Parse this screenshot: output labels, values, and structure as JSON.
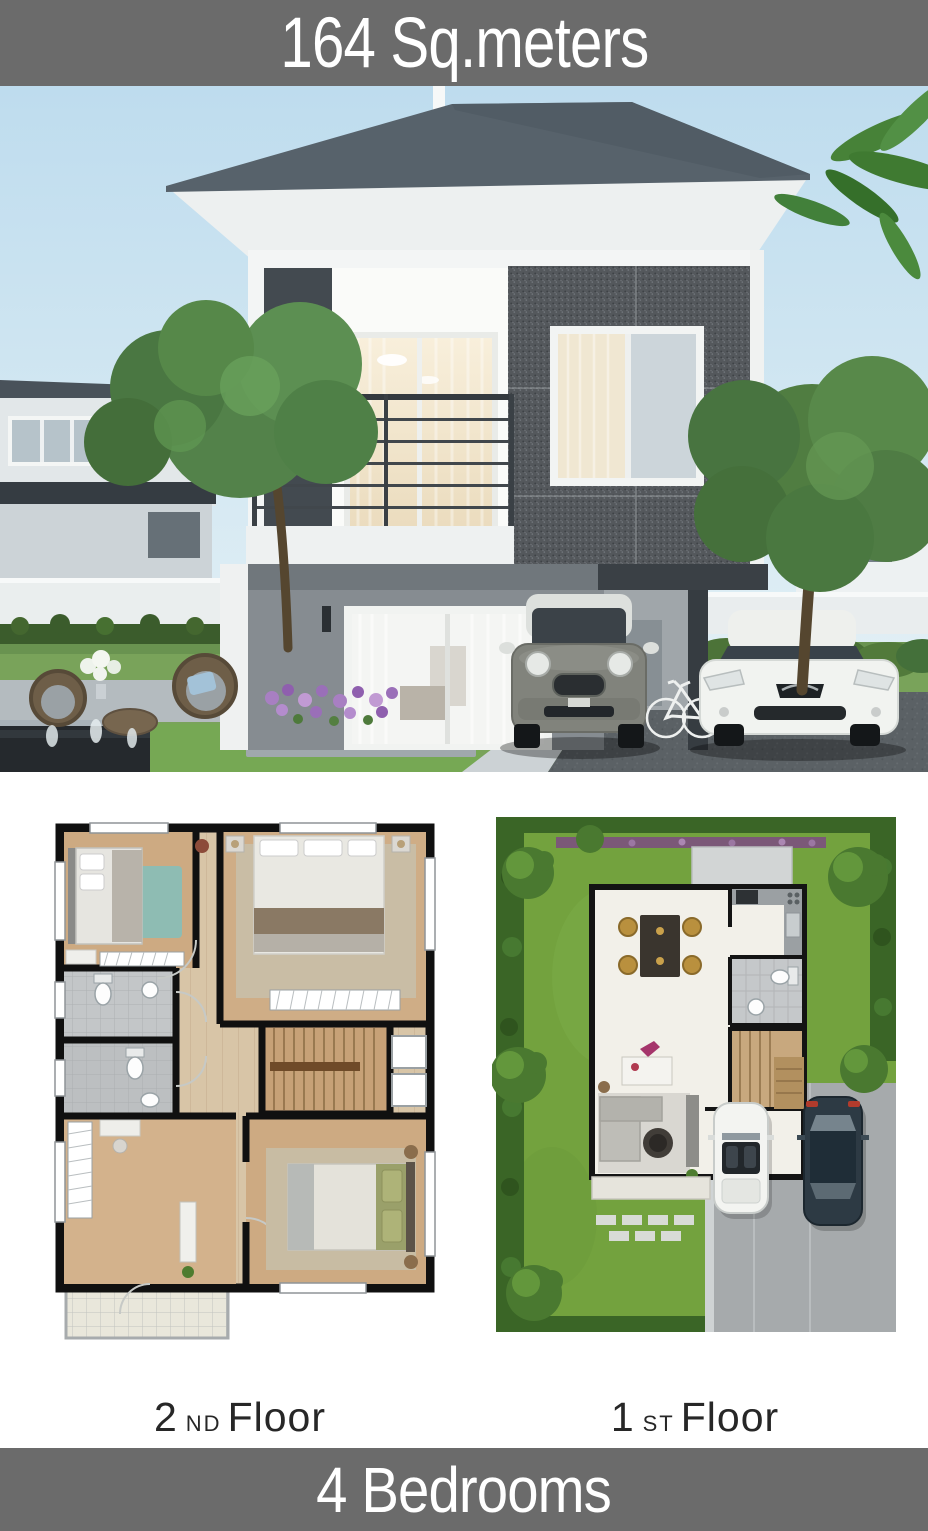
{
  "header": {
    "title": "164 Sq.meters"
  },
  "floor_labels": {
    "second": {
      "number": "2",
      "ordinal": "ND",
      "word": "Floor"
    },
    "first": {
      "number": "1",
      "ordinal": "ST",
      "word": "Floor"
    }
  },
  "footer": {
    "title": "4 Bedrooms"
  },
  "colors": {
    "banner_bg": "#6b6b6b",
    "banner_text": "#ffffff",
    "label_text": "#272727",
    "sky": "#c3ddec",
    "roof": "#57626b",
    "house_wall_gray": "#868c91",
    "speckled_wall": "#54585c",
    "lawn_green": "#73a23e",
    "driveway_gray": "#5b6165",
    "plan_wood": "#cdaa82",
    "plan_tile": "#c3c6c8"
  }
}
